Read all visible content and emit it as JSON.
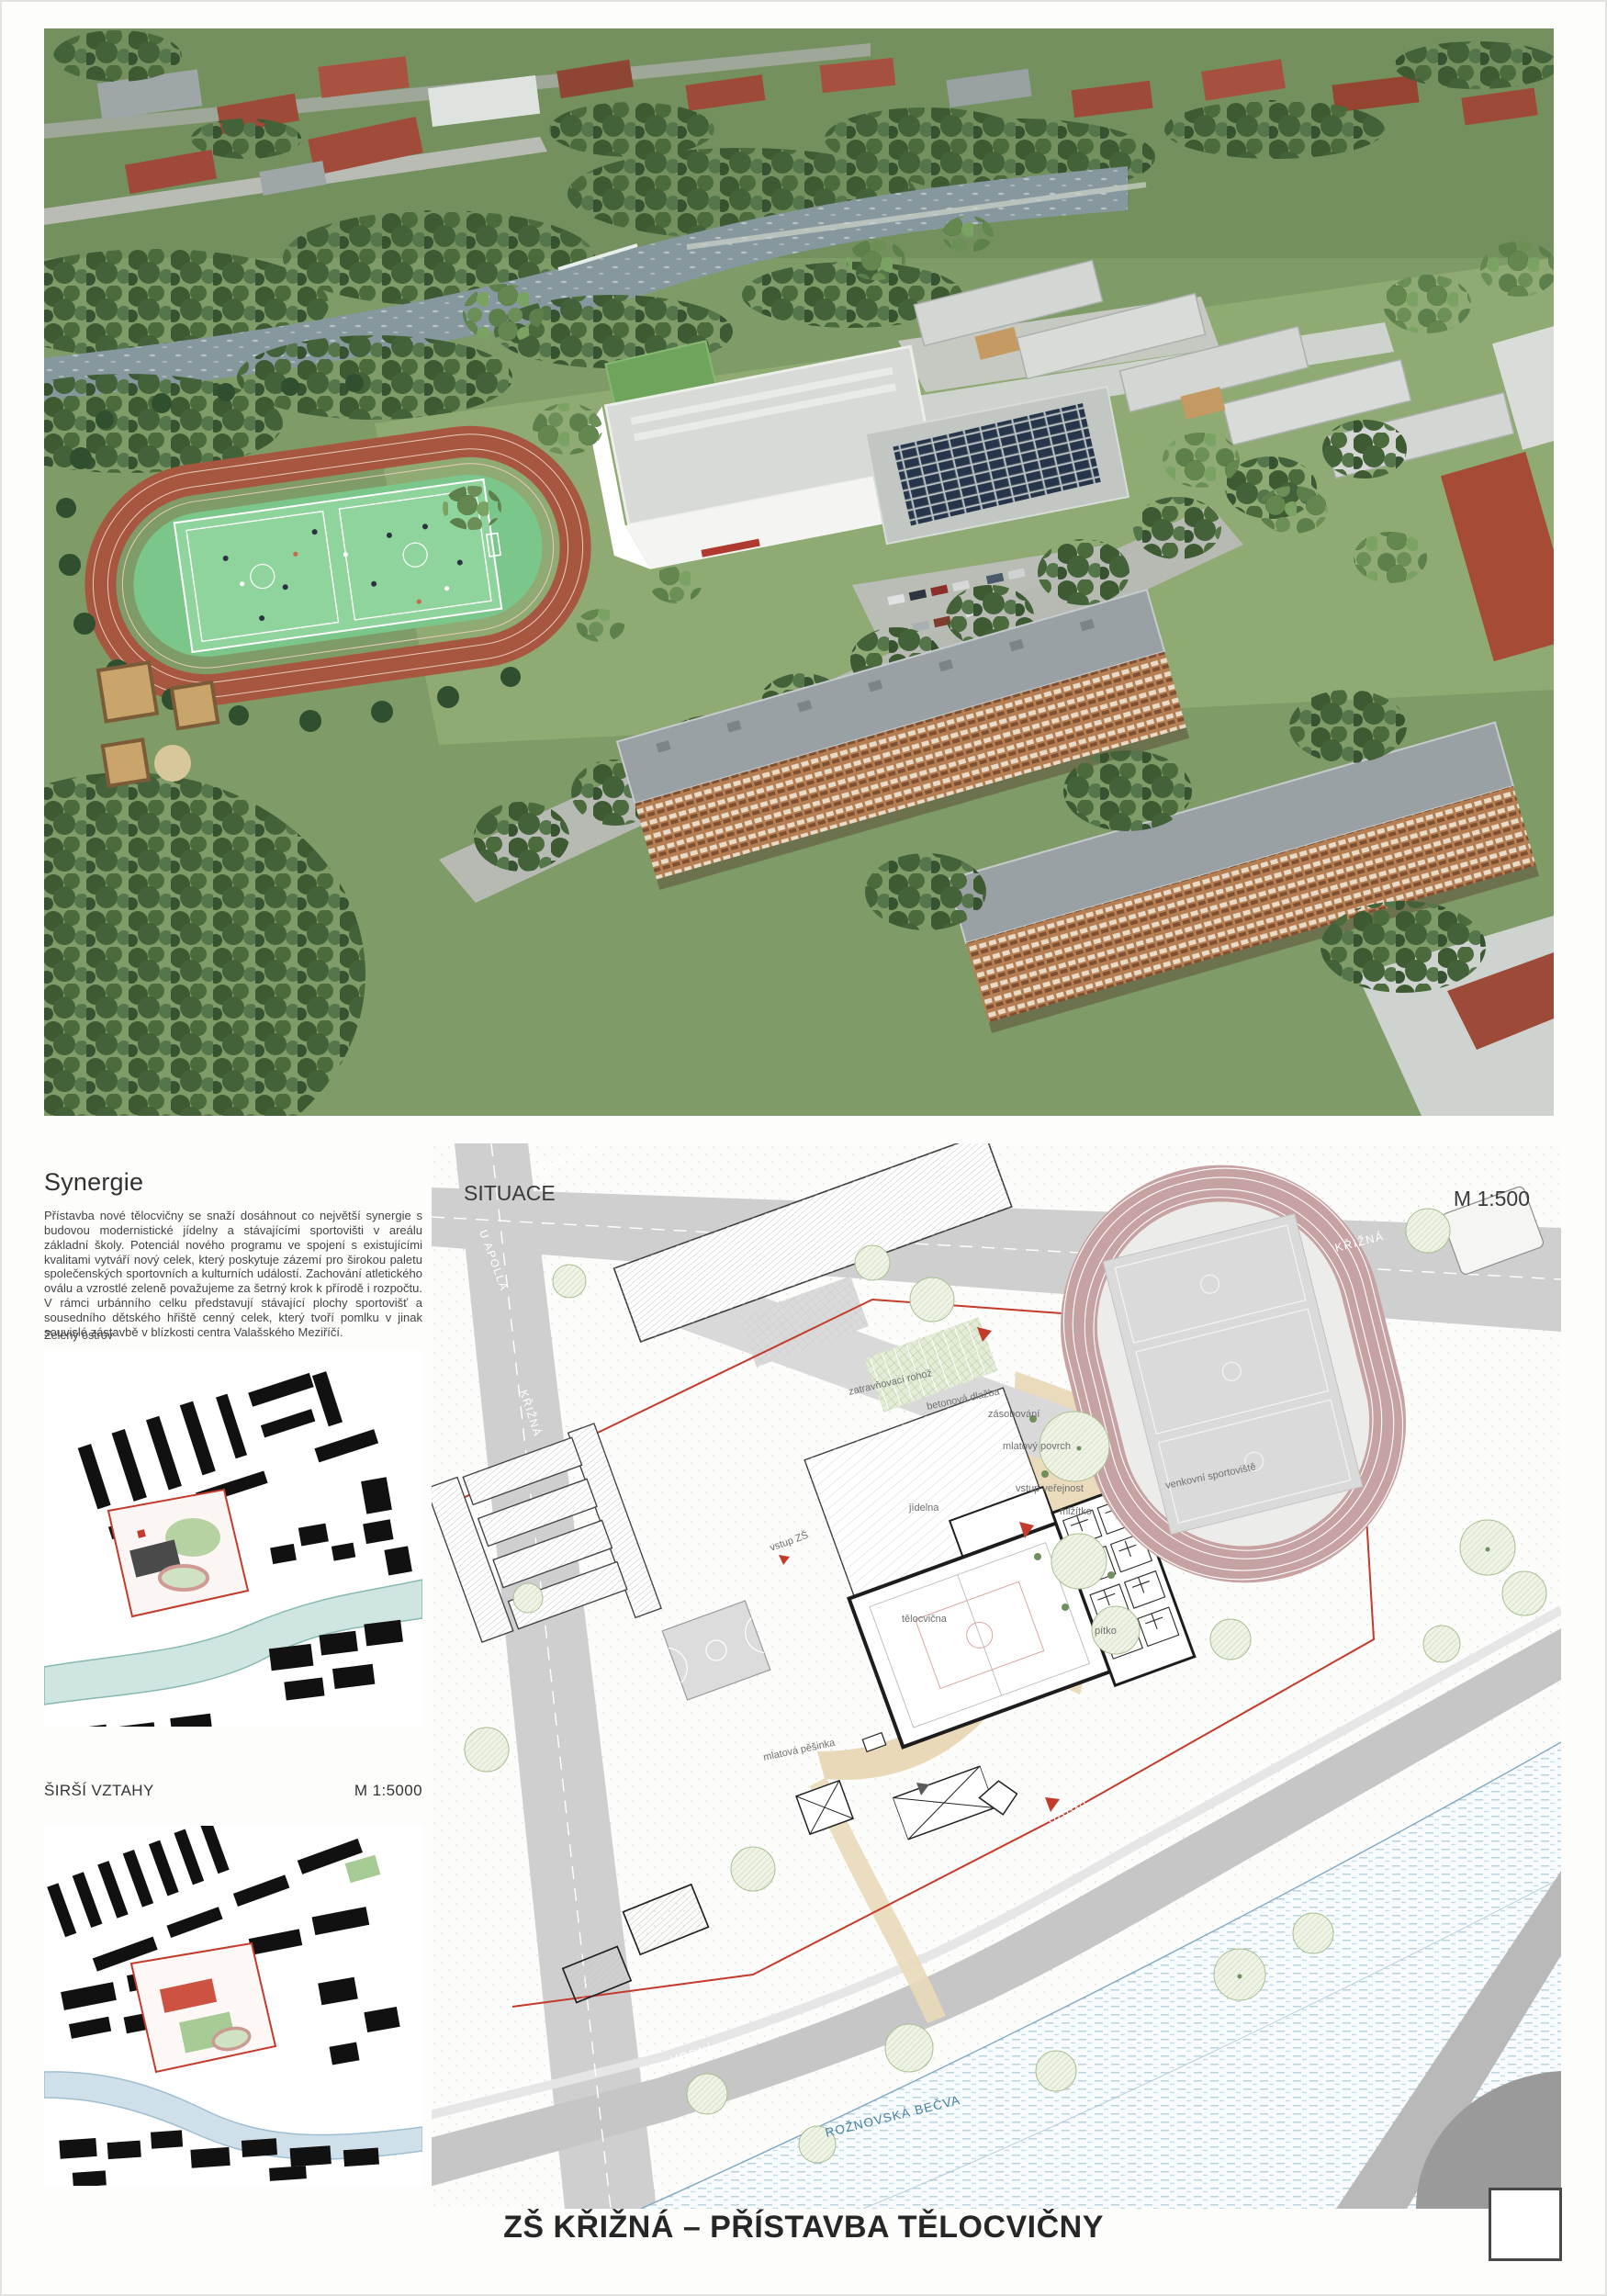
{
  "poster": {
    "title": "ZŠ KŘIŽNÁ – PŘÍSTAVBA TĚLOCVIČNY"
  },
  "synergy": {
    "heading": "Synergie",
    "body": "Přístavba nové tělocvičny se snaží dosáhnout co největší synergie s budovou modernistické jídelny a stávajícími sportovišti v areálu základní školy. Potenciál nového programu ve spojení s existujícími kvalitami vytváří nový celek, který poskytuje zázemí pro širokou paletu společenských sportovních a kulturních událostí. Zachování atletického oválu a vzrostlé zeleně považujeme za šetrný krok k přírodě i rozpočtu. V rámci urbánního celku představují stávající plochy sportovišť a sousedního dětského hřiště cenný celek, který tvoří pomlku v jinak souvislé zástavbě v blízkosti centra Valašského Meziříčí."
  },
  "green_island": {
    "label": "Zelený ostrov"
  },
  "wider_relations": {
    "label": "ŠIRŠÍ VZTAHY",
    "scale": "M 1:5000"
  },
  "site_plan": {
    "label": "SITUACE",
    "scale": "M 1:500",
    "streets": {
      "krizna": "KŘIŽNÁ",
      "u_apolla": "U APOLLA",
      "bratri": "BRATŘÍ Č.",
      "vodni": "VODNÍ"
    },
    "river": "ROŽNOVSKÁ BEČVA",
    "annotations": {
      "zatravnovaci_rohoz": "zatravňovací rohož",
      "betonova_dlazba": "betonová dlažba",
      "zasobovani": "zásobování",
      "mlatovy_povrch": "mlatový povrch",
      "vstup_verejnost": "vstup veřejnost",
      "vstup_zs": "vstup ZŠ",
      "jidelna": "jídelna",
      "telocvicna": "tělocvična",
      "mlzitko": "mlžítko",
      "pitko": "pítko",
      "mlatova_pesinka": "mlatová pěšinka",
      "venkovni_sportoviste": "venkovní sportoviště"
    }
  },
  "colors": {
    "boundary_red": "#c23b2b",
    "track_pink": "#c7a2a3",
    "river_blue": "#44809f",
    "render_track_red": "#a75740",
    "render_court_green": "#7bc68b"
  }
}
